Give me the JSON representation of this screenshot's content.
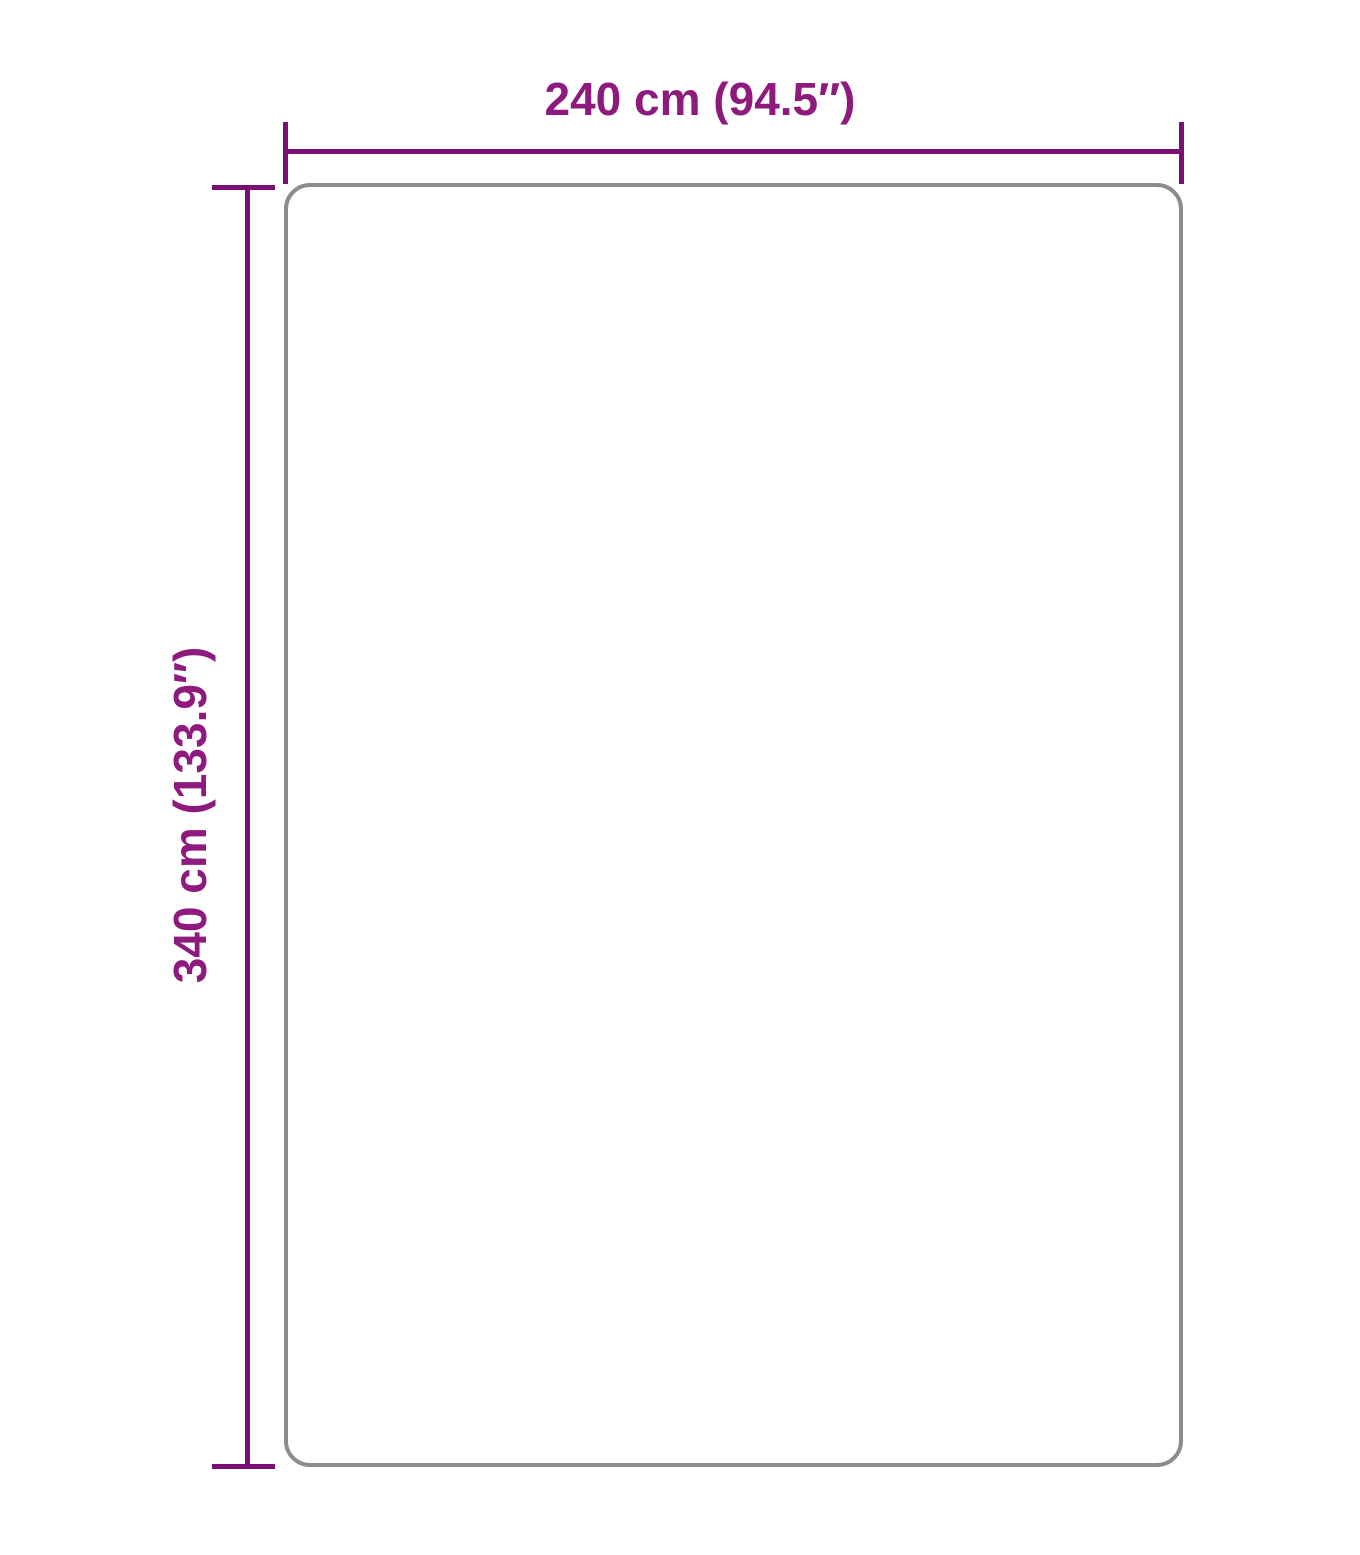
{
  "diagram": {
    "type": "product-dimension-diagram",
    "width_label": "240 cm (94.5″)",
    "height_label": "340 cm (133.9″)"
  },
  "colors": {
    "dimension-line": "#7a1074",
    "dimension-text": "#8e1a7e",
    "outline": "#8c8c8c",
    "background": "#ffffff"
  }
}
